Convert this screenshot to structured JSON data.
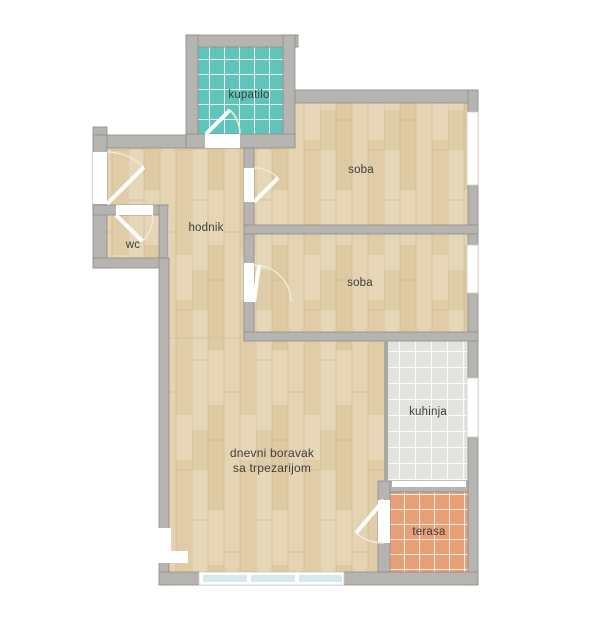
{
  "palette": {
    "bg": "#ffffff",
    "wall": "#b5b4b1",
    "wallEdge": "#8e8d89",
    "wood": "#e3d2b1",
    "tealTile": "#5fc5bb",
    "kitchenTile": "#e3e3e0",
    "terraceTile": "#e9a077",
    "windowPane": "#d8e8ea",
    "ink": "#3d3d3d"
  },
  "floorplan": {
    "rooms": [
      {
        "id": "kupatilo",
        "label": "kupatilo"
      },
      {
        "id": "soba-1",
        "label": "soba"
      },
      {
        "id": "soba-2",
        "label": "soba"
      },
      {
        "id": "hodnik",
        "label": "hodnik"
      },
      {
        "id": "wc",
        "label": "wc"
      },
      {
        "id": "dnevni-boravak",
        "label": "dnevni boravak",
        "label2": "sa trpezarijom"
      },
      {
        "id": "kuhinja",
        "label": "kuhinja"
      },
      {
        "id": "terasa",
        "label": "terasa"
      }
    ]
  }
}
